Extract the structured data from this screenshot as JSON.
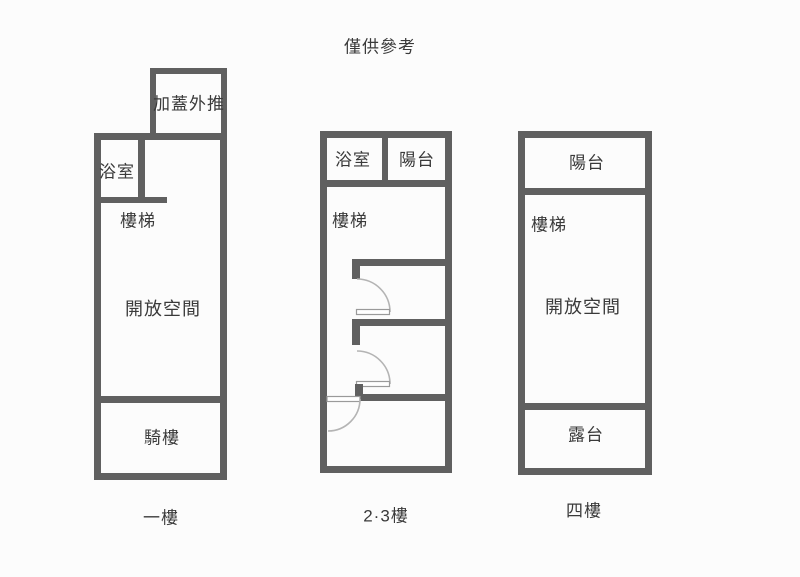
{
  "title": "僅供參考",
  "colors": {
    "page_bg": "#fcfcfc",
    "wall": "#606060",
    "label_text": "#3a3a3a",
    "door_arc": "#b4b4b4",
    "door_leaf_edge": "#9a9a9a"
  },
  "plans": [
    {
      "caption": "一樓",
      "rooms": {
        "extension": "加蓋外推",
        "bathroom": "浴室",
        "stairs": "樓梯",
        "open_space": "開放空間",
        "arcade": "騎樓"
      }
    },
    {
      "caption": "2·3樓",
      "rooms": {
        "bathroom": "浴室",
        "balcony": "陽台",
        "stairs": "樓梯"
      }
    },
    {
      "caption": "四樓",
      "rooms": {
        "balcony": "陽台",
        "stairs": "樓梯",
        "open_space": "開放空間",
        "terrace": "露台"
      }
    }
  ]
}
